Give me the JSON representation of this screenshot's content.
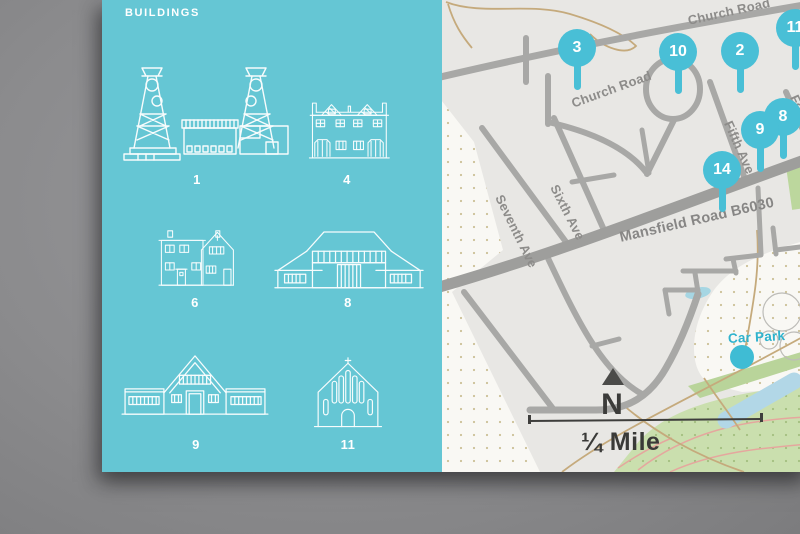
{
  "panel": {
    "title": "BUILDINGS",
    "background_color": "#65c6d4",
    "items": [
      {
        "number": "1",
        "building": "colliery-with-headstocks"
      },
      {
        "number": "4",
        "building": "terraced-houses"
      },
      {
        "number": "6",
        "building": "pair-of-houses"
      },
      {
        "number": "8",
        "building": "long-hall"
      },
      {
        "number": "9",
        "building": "pavilion"
      },
      {
        "number": "11",
        "building": "church"
      }
    ]
  },
  "map": {
    "pins": [
      {
        "number": "3"
      },
      {
        "number": "10"
      },
      {
        "number": "2"
      },
      {
        "number": "11"
      },
      {
        "number": "8"
      },
      {
        "number": "9"
      },
      {
        "number": "14"
      }
    ],
    "labels": {
      "church_road_upper": "Church Road",
      "church_road_lower": "Church Road",
      "seventh_ave": "Seventh Ave",
      "sixth_ave": "Sixth Ave",
      "fifth_ave": "Fifth Ave",
      "fourth_ave": "Fourth Ave",
      "mansfield_road": "Mansfield Road B6030",
      "car_park": "Car Park",
      "north": "N",
      "scale": "¼ Mile"
    },
    "colors": {
      "pin": "#49bfd6",
      "road": "#a8a8a6",
      "main_road": "#9e9e9c",
      "water": "#b2d7e7",
      "park_green": "#cadfae",
      "trail": "#c5aa7c",
      "car_park_text": "#2fb3cd"
    }
  }
}
